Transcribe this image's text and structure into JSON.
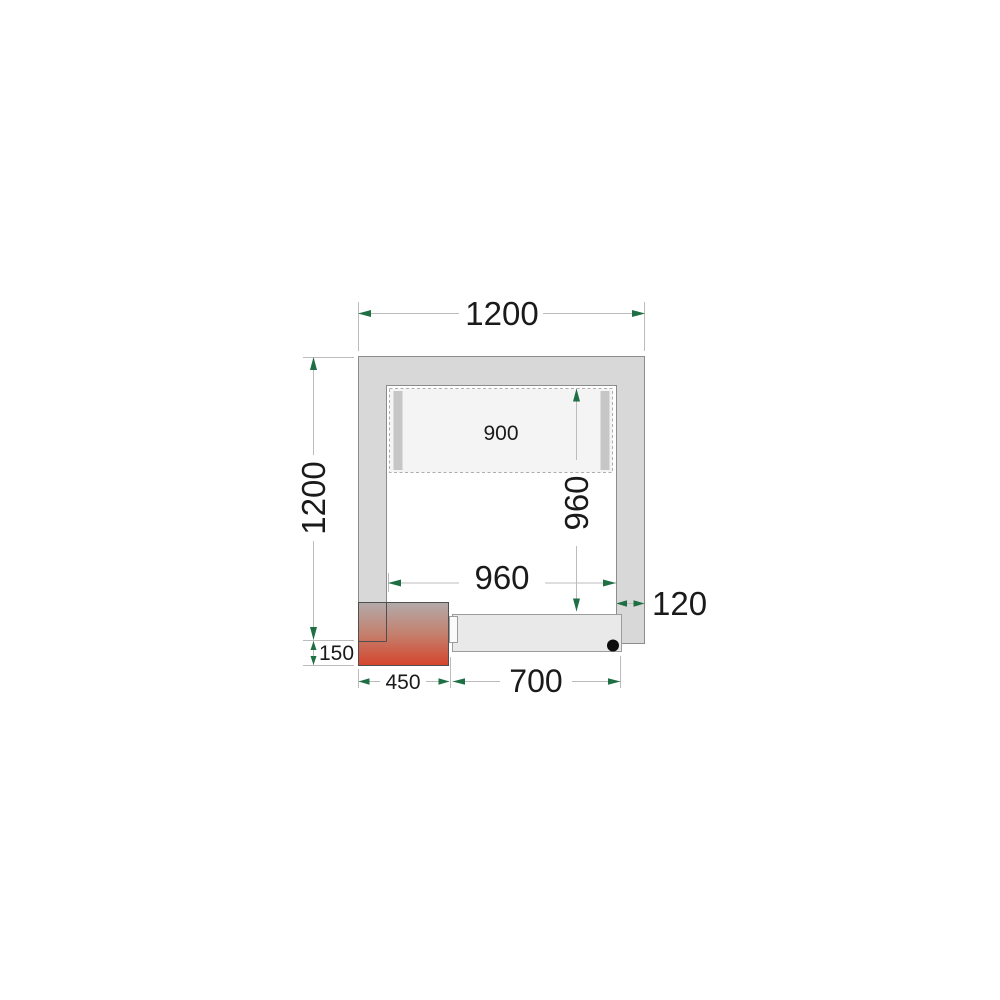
{
  "figure": {
    "kind": "cold-room floor plan technical drawing",
    "background": "#ffffff"
  },
  "colors": {
    "wall_gray": "#d8d8d8",
    "wall_border": "#8c8c8c",
    "arrow_green": "#1e7044",
    "dim_line_gray": "#bcbcbc",
    "heater_gradient_top": "#b2abaa",
    "heater_gradient_mid": "#c4806e",
    "heater_gradient_bottom": "#d5452c",
    "door_fill": "#e9e9e9",
    "evaporator_fill": "#f4f4f4",
    "hinge_dot": "#0d0d0d"
  },
  "dims": {
    "outer_width": "1200",
    "outer_depth": "1200",
    "evaporator_width": "900",
    "inner_depth": "960",
    "inner_width": "960",
    "wall_thickness": "120",
    "corner_offset": "150",
    "corner_unit_width": "450",
    "door_width": "700"
  }
}
